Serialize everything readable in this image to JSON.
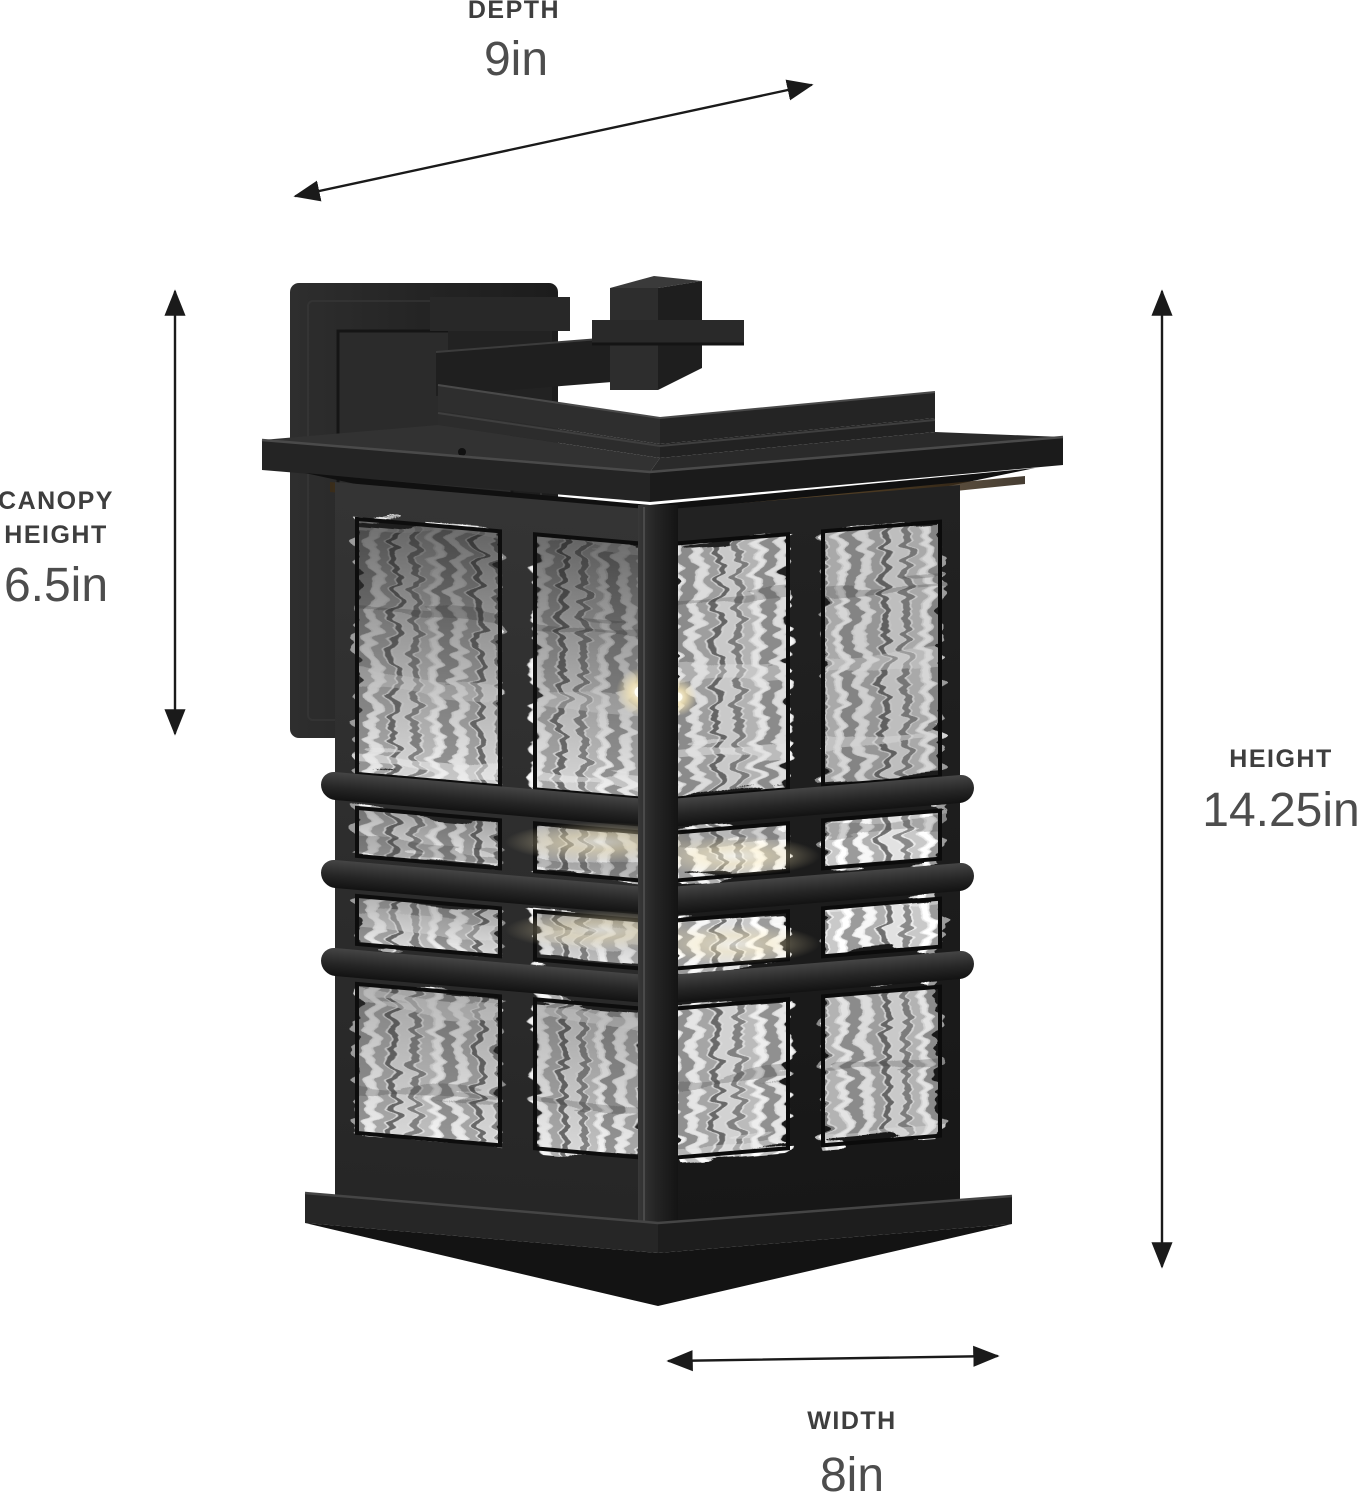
{
  "diagram": {
    "background": "#ffffff",
    "annotations": {
      "depth": {
        "label": "DEPTH",
        "value": "9in"
      },
      "canopy": {
        "label_line1": "CANOPY",
        "label_line2": "HEIGHT",
        "value": "6.5in"
      },
      "height": {
        "label": "HEIGHT",
        "value": "14.25in"
      },
      "width": {
        "label": "WIDTH",
        "value": "8in"
      }
    },
    "product_image": {
      "semantic_name": "black-outdoor-wall-lantern-with-water-glass",
      "colors": {
        "fixture_black": "#232323",
        "fixture_dark": "#161616",
        "fixture_highlight": "#454545",
        "glass_light": "#ececec",
        "glass_shadow": "#6f6f6f",
        "warm_glow": "#f7e7b6",
        "bronze_glint": "#7a5a33"
      }
    },
    "arrow_color": "#1a1a1a",
    "label_text_color": "#3e3e3e",
    "value_text_color": "#4d4d4d"
  }
}
